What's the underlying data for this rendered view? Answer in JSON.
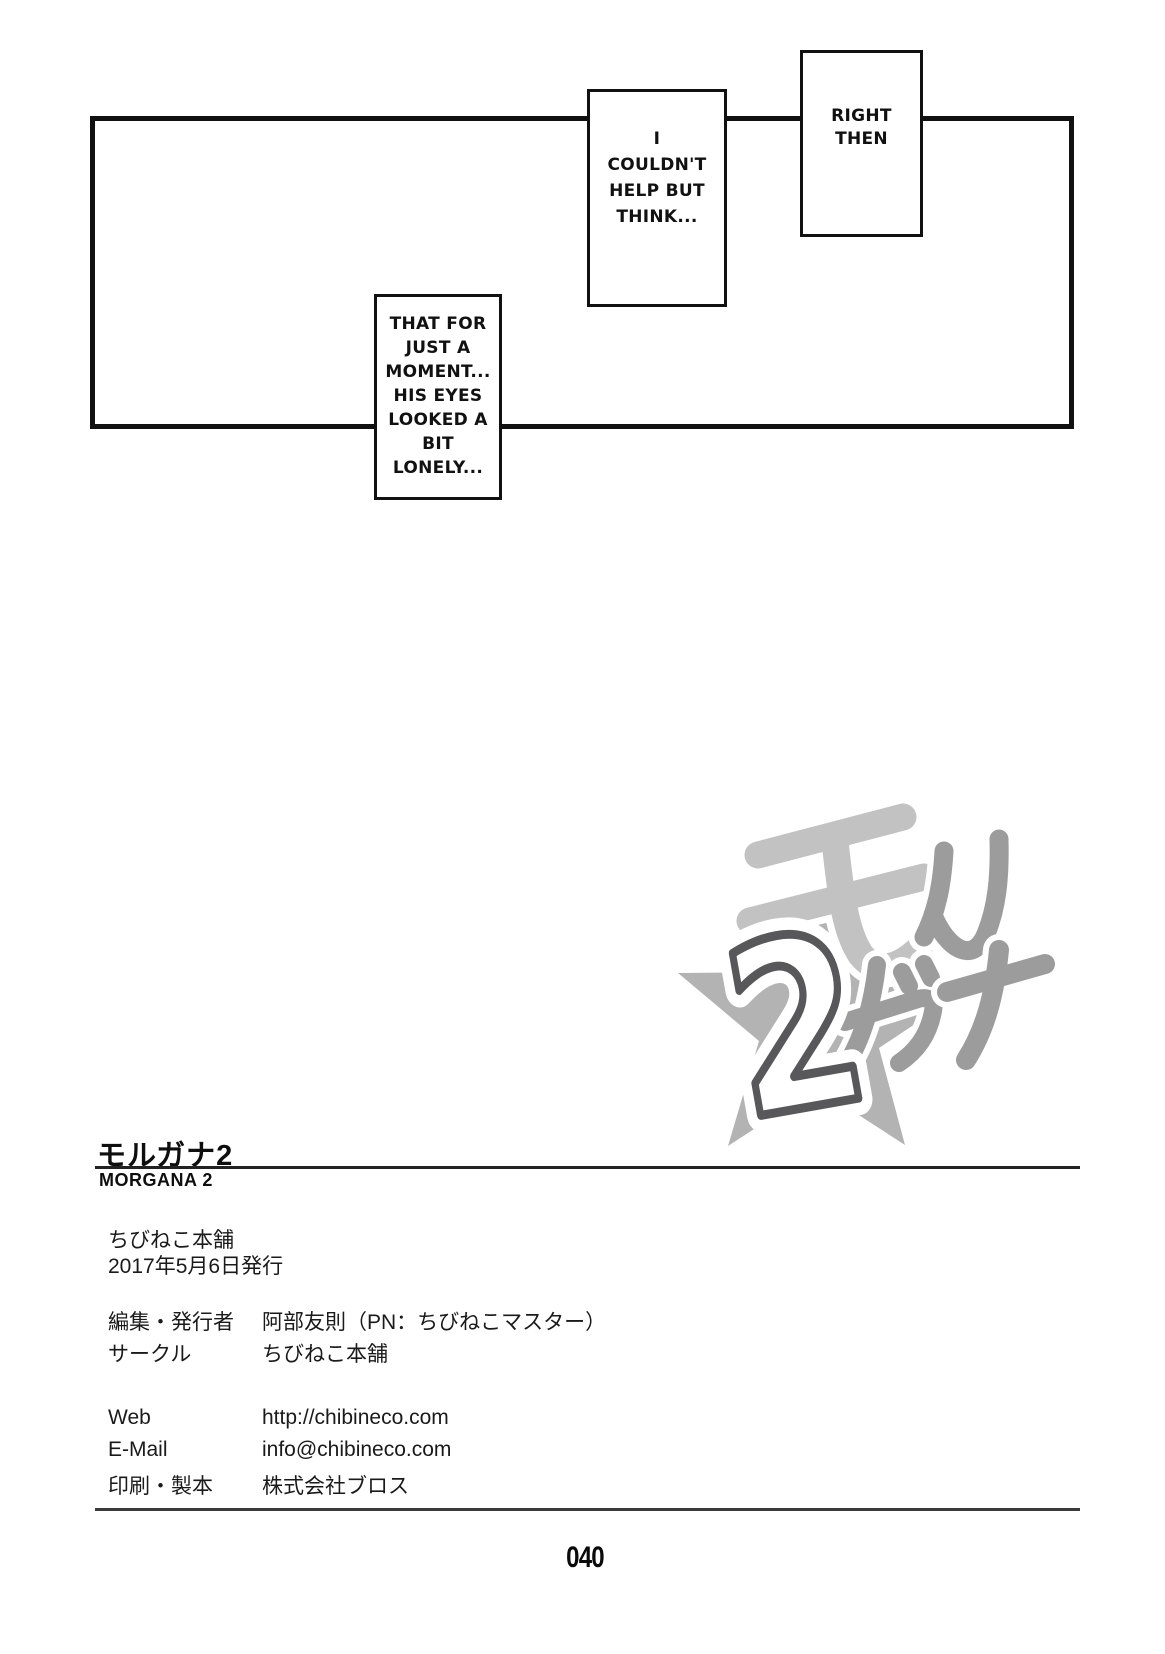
{
  "page": {
    "number": "040"
  },
  "dialogue": {
    "caption_right": {
      "lines": [
        "RIGHT",
        "THEN"
      ]
    },
    "caption_middle": {
      "lines": [
        "I",
        "COULDN'T",
        "HELP BUT",
        "THINK..."
      ]
    },
    "caption_left": {
      "lines": [
        "THAT FOR",
        "JUST A",
        "MOMENT...",
        "HIS EYES",
        "LOOKED A",
        "BIT",
        "LONELY..."
      ]
    }
  },
  "logo": {
    "kana_top": "モル",
    "kana_bottom": "ガナ",
    "number": "2",
    "colors": {
      "kana_light": "#c2c2c2",
      "kana_dark": "#9c9c9c",
      "number_stroke": "#58585a",
      "star": "#b3b3b3",
      "halo": "#ffffff"
    }
  },
  "colophon": {
    "title_jp": "モルガナ2",
    "title_en": "MORGANA 2",
    "circle_name": "ちびねこ本舗",
    "issue_date": "2017年5月6日発行",
    "rows": [
      {
        "label": "編集・発行者",
        "value": "阿部友則（PN：ちびねこマスター）"
      },
      {
        "label": "サークル",
        "value": "ちびねこ本舗"
      },
      {
        "label": "Web",
        "value": "http://chibineco.com"
      },
      {
        "label": "E-Mail",
        "value": "info@chibineco.com"
      },
      {
        "label": "印刷・製本",
        "value": "株式会社ブロス"
      }
    ]
  }
}
